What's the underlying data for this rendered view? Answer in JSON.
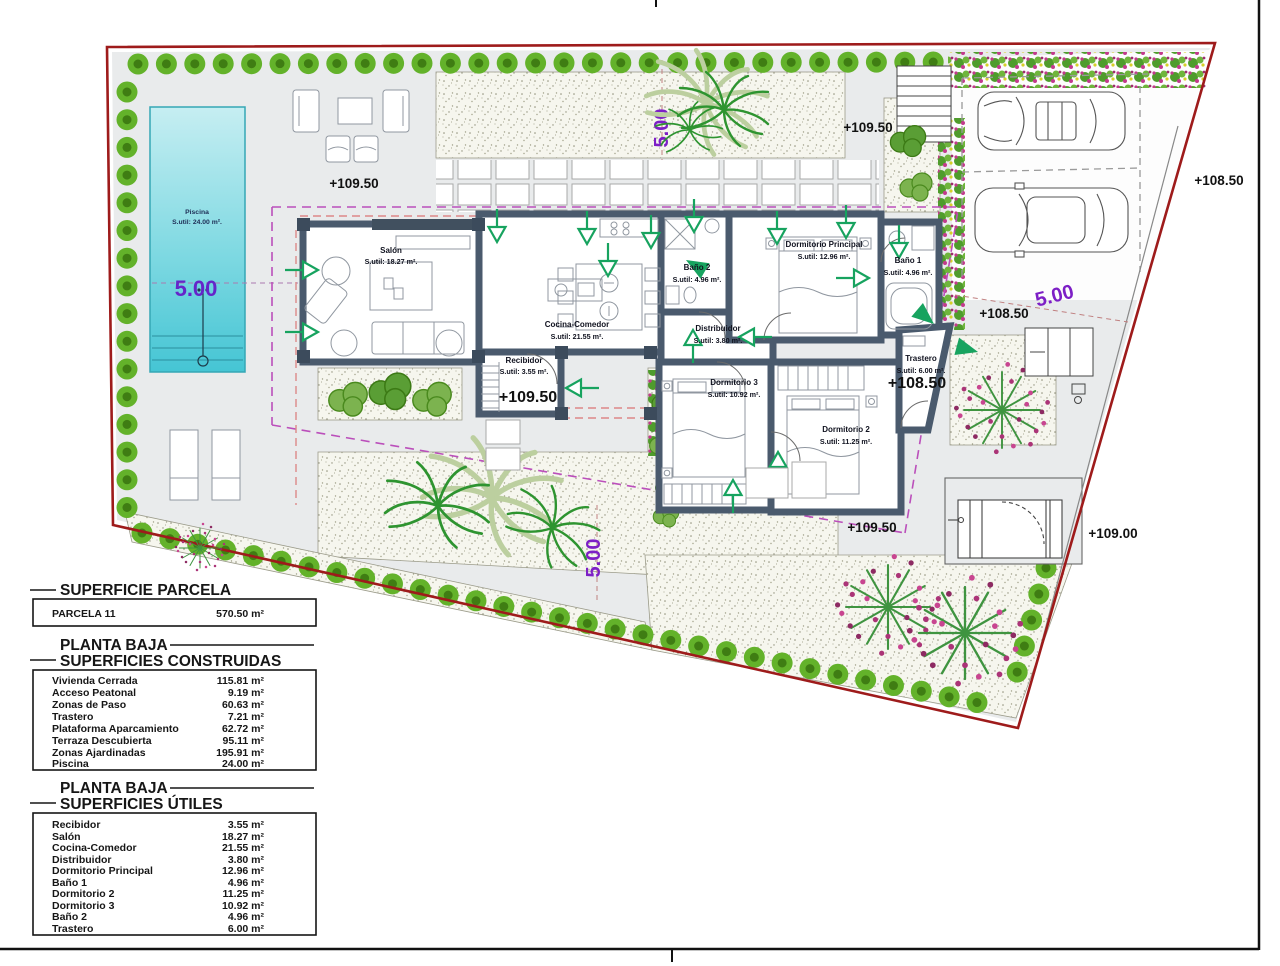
{
  "drawing": {
    "pool": {
      "name": "Piscina",
      "area": "S.util: 24.00 m²."
    },
    "rooms": [
      {
        "name": "Salón",
        "area": "S.util: 18.27 m²."
      },
      {
        "name": "Cocina-Comedor",
        "area": "S.util: 21.55 m²."
      },
      {
        "name": "Recibidor",
        "area": "S.util: 3.55 m²."
      },
      {
        "name": "Baño 2",
        "area": "S.util: 4.96 m²."
      },
      {
        "name": "Distribuidor",
        "area": "S.util: 3.80 m²."
      },
      {
        "name": "Dormitorio Principal",
        "area": "S.util: 12.96 m²."
      },
      {
        "name": "Baño 1",
        "area": "S.util: 4.96 m²."
      },
      {
        "name": "Dormitorio 3",
        "area": "S.util: 10.92 m²."
      },
      {
        "name": "Dormitorio 2",
        "area": "S.util: 11.25 m²."
      },
      {
        "name": "Trastero",
        "area": "S.util: 6.00 m²."
      }
    ],
    "levels": [
      "+109.50",
      "+109.50",
      "+109.50",
      "+108.50",
      "+108.50",
      "+109.50",
      "+108.50",
      "+109.00"
    ],
    "dims": [
      "5.00",
      "5.00",
      "5.00",
      "5.00"
    ]
  },
  "tables": {
    "parcela": {
      "title": "SUPERFICIE PARCELA",
      "rows": [
        {
          "label": "PARCELA 11",
          "value": "570.50 m²"
        }
      ]
    },
    "construidas": {
      "title_line1": "PLANTA BAJA",
      "title_line2": "SUPERFICIES CONSTRUIDAS",
      "rows": [
        {
          "label": "Vivienda Cerrada",
          "value": "115.81 m²"
        },
        {
          "label": "Acceso Peatonal",
          "value": "9.19 m²"
        },
        {
          "label": "Zonas de Paso",
          "value": "60.63 m²"
        },
        {
          "label": "Trastero",
          "value": "7.21 m²"
        },
        {
          "label": "Plataforma Aparcamiento",
          "value": "62.72 m²"
        },
        {
          "label": "Terraza Descubierta",
          "value": "95.11 m²"
        },
        {
          "label": "Zonas Ajardinadas",
          "value": "195.91 m²"
        },
        {
          "label": "Piscina",
          "value": "24.00 m²"
        }
      ]
    },
    "utiles": {
      "title_line1": "PLANTA BAJA",
      "title_line2": "SUPERFICIES ÚTILES",
      "rows": [
        {
          "label": "Recibidor",
          "value": "3.55 m²"
        },
        {
          "label": "Salón",
          "value": "18.27 m²"
        },
        {
          "label": "Cocina-Comedor",
          "value": "21.55 m²"
        },
        {
          "label": "Distribuidor",
          "value": "3.80 m²"
        },
        {
          "label": "Dormitorio Principal",
          "value": "12.96 m²"
        },
        {
          "label": "Baño 1",
          "value": "4.96 m²"
        },
        {
          "label": "Dormitorio 2",
          "value": "11.25 m²"
        },
        {
          "label": "Dormitorio 3",
          "value": "10.92 m²"
        },
        {
          "label": "Baño 2",
          "value": "4.96 m²"
        },
        {
          "label": "Trastero",
          "value": "6.00 m²"
        }
      ]
    }
  },
  "colors": {
    "boundary_red": "#9e1b1b",
    "wall": "#4a5a6d",
    "hedge_green": "#63b22a",
    "pool_cyan": "#4cc9d6",
    "dim_purple": "#7d1fc6",
    "arrow_green": "#17a35f",
    "envelope_magenta": "#bb4fbb"
  }
}
